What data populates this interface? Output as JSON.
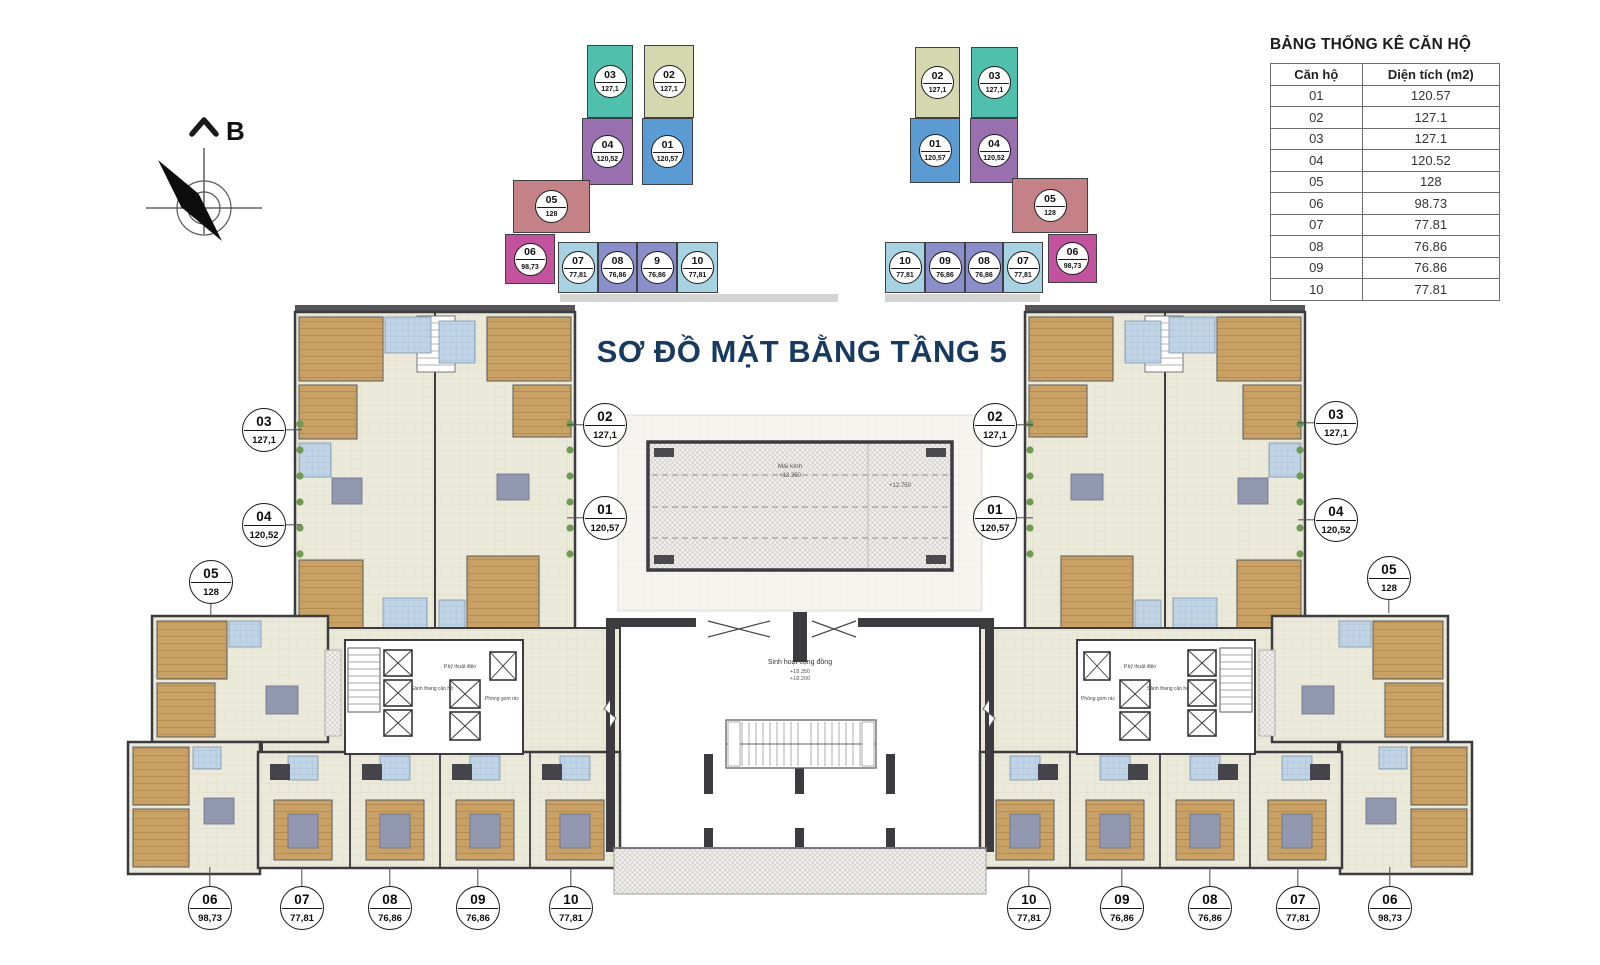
{
  "title": {
    "text": "SƠ ĐỒ MẶT BẰNG TẦNG 5",
    "color": "#173a63"
  },
  "compass": {
    "label": "B"
  },
  "stats_table": {
    "title": "BẢNG THỐNG KÊ CĂN HỘ",
    "columns": [
      "Căn hộ",
      "Diện tích (m2)"
    ],
    "rows": [
      {
        "unit": "01",
        "area": "120.57"
      },
      {
        "unit": "02",
        "area": "127.1"
      },
      {
        "unit": "03",
        "area": "127.1"
      },
      {
        "unit": "04",
        "area": "120.52"
      },
      {
        "unit": "05",
        "area": "128"
      },
      {
        "unit": "06",
        "area": "98.73"
      },
      {
        "unit": "07",
        "area": "77.81"
      },
      {
        "unit": "08",
        "area": "76.86"
      },
      {
        "unit": "09",
        "area": "76.86"
      },
      {
        "unit": "10",
        "area": "77.81"
      }
    ]
  },
  "keyplan_left": {
    "blocks": [
      {
        "unit": "03",
        "area": "127,1",
        "x": 587,
        "y": 45,
        "w": 46,
        "h": 73,
        "color": "#4fbfae"
      },
      {
        "unit": "02",
        "area": "127,1",
        "x": 644,
        "y": 45,
        "w": 50,
        "h": 73,
        "color": "#d5d8ae"
      },
      {
        "unit": "04",
        "area": "120,52",
        "x": 582,
        "y": 118,
        "w": 51,
        "h": 67,
        "color": "#9a6fb0"
      },
      {
        "unit": "01",
        "area": "120,57",
        "x": 642,
        "y": 118,
        "w": 51,
        "h": 67,
        "color": "#5b9bd3"
      },
      {
        "unit": "05",
        "area": "128",
        "x": 513,
        "y": 180,
        "w": 77,
        "h": 53,
        "color": "#c48287"
      },
      {
        "unit": "06",
        "area": "98,73",
        "x": 505,
        "y": 234,
        "w": 50,
        "h": 50,
        "color": "#c2519e"
      },
      {
        "unit": "07",
        "area": "77,81",
        "x": 558,
        "y": 242,
        "w": 40,
        "h": 51,
        "color": "#a7d2e2"
      },
      {
        "unit": "08",
        "area": "76,86",
        "x": 598,
        "y": 242,
        "w": 39,
        "h": 51,
        "color": "#8a8eca"
      },
      {
        "unit": "9",
        "area": "76,86",
        "x": 637,
        "y": 242,
        "w": 40,
        "h": 51,
        "color": "#8a8eca"
      },
      {
        "unit": "10",
        "area": "77,81",
        "x": 677,
        "y": 242,
        "w": 41,
        "h": 51,
        "color": "#a7d2e2"
      }
    ]
  },
  "keyplan_right": {
    "blocks": [
      {
        "unit": "02",
        "area": "127,1",
        "x": 915,
        "y": 47,
        "w": 45,
        "h": 71,
        "color": "#d5d8ae"
      },
      {
        "unit": "03",
        "area": "127,1",
        "x": 971,
        "y": 47,
        "w": 47,
        "h": 71,
        "color": "#4fbfae"
      },
      {
        "unit": "01",
        "area": "120,57",
        "x": 910,
        "y": 118,
        "w": 50,
        "h": 65,
        "color": "#5b9bd3"
      },
      {
        "unit": "04",
        "area": "120,52",
        "x": 970,
        "y": 118,
        "w": 48,
        "h": 65,
        "color": "#9a6fb0"
      },
      {
        "unit": "05",
        "area": "128",
        "x": 1012,
        "y": 178,
        "w": 76,
        "h": 55,
        "color": "#c48287"
      },
      {
        "unit": "10",
        "area": "77,81",
        "x": 885,
        "y": 242,
        "w": 40,
        "h": 51,
        "color": "#a7d2e2"
      },
      {
        "unit": "09",
        "area": "76,86",
        "x": 925,
        "y": 242,
        "w": 40,
        "h": 51,
        "color": "#8a8eca"
      },
      {
        "unit": "08",
        "area": "76,86",
        "x": 965,
        "y": 242,
        "w": 38,
        "h": 51,
        "color": "#8a8eca"
      },
      {
        "unit": "07",
        "area": "77,81",
        "x": 1003,
        "y": 242,
        "w": 40,
        "h": 51,
        "color": "#a7d2e2"
      },
      {
        "unit": "06",
        "area": "98,73",
        "x": 1048,
        "y": 234,
        "w": 49,
        "h": 49,
        "color": "#c2519e"
      }
    ]
  },
  "callouts": [
    {
      "unit": "03",
      "area": "127,1",
      "x": 264,
      "y": 430,
      "dir": "right"
    },
    {
      "unit": "04",
      "area": "120,52",
      "x": 264,
      "y": 525,
      "dir": "right"
    },
    {
      "unit": "02",
      "area": "127,1",
      "x": 605,
      "y": 425,
      "dir": "left"
    },
    {
      "unit": "01",
      "area": "120,57",
      "x": 605,
      "y": 518,
      "dir": "left"
    },
    {
      "unit": "05",
      "area": "128",
      "x": 211,
      "y": 582,
      "dir": "down"
    },
    {
      "unit": "06",
      "area": "98,73",
      "x": 210,
      "y": 908,
      "dir": "up"
    },
    {
      "unit": "07",
      "area": "77,81",
      "x": 302,
      "y": 908,
      "dir": "up"
    },
    {
      "unit": "08",
      "area": "76,86",
      "x": 390,
      "y": 908,
      "dir": "up"
    },
    {
      "unit": "09",
      "area": "76,86",
      "x": 478,
      "y": 908,
      "dir": "up"
    },
    {
      "unit": "10",
      "area": "77,81",
      "x": 571,
      "y": 908,
      "dir": "up"
    },
    {
      "unit": "02",
      "area": "127,1",
      "x": 995,
      "y": 425,
      "dir": "right"
    },
    {
      "unit": "01",
      "area": "120,57",
      "x": 995,
      "y": 518,
      "dir": "right"
    },
    {
      "unit": "03",
      "area": "127,1",
      "x": 1336,
      "y": 423,
      "dir": "left"
    },
    {
      "unit": "04",
      "area": "120,52",
      "x": 1336,
      "y": 520,
      "dir": "left"
    },
    {
      "unit": "05",
      "area": "128",
      "x": 1389,
      "y": 578,
      "dir": "down"
    },
    {
      "unit": "10",
      "area": "77,81",
      "x": 1029,
      "y": 908,
      "dir": "up"
    },
    {
      "unit": "09",
      "area": "76,86",
      "x": 1122,
      "y": 908,
      "dir": "up"
    },
    {
      "unit": "08",
      "area": "76,86",
      "x": 1210,
      "y": 908,
      "dir": "up"
    },
    {
      "unit": "07",
      "area": "77,81",
      "x": 1298,
      "y": 908,
      "dir": "up"
    },
    {
      "unit": "06",
      "area": "98,73",
      "x": 1390,
      "y": 908,
      "dir": "up"
    }
  ],
  "plan_labels": {
    "community": "Sinh hoạt cộng đồng",
    "community_level_a": "+18.350",
    "community_level_b": "+18.200",
    "skylight": "Mái kính",
    "skylight_level_a": "+13.350",
    "skylight_level_b": "+12.750",
    "lobby_left": "Sảnh thang căn hộ",
    "lobby_right": "Sảnh thang căn hộ",
    "trash_left": "Phòng gom rác",
    "trash_right": "Phòng gom rác",
    "tech_left": "P.kỹ thuật điện",
    "tech_right": "P.kỹ thuật điện"
  }
}
